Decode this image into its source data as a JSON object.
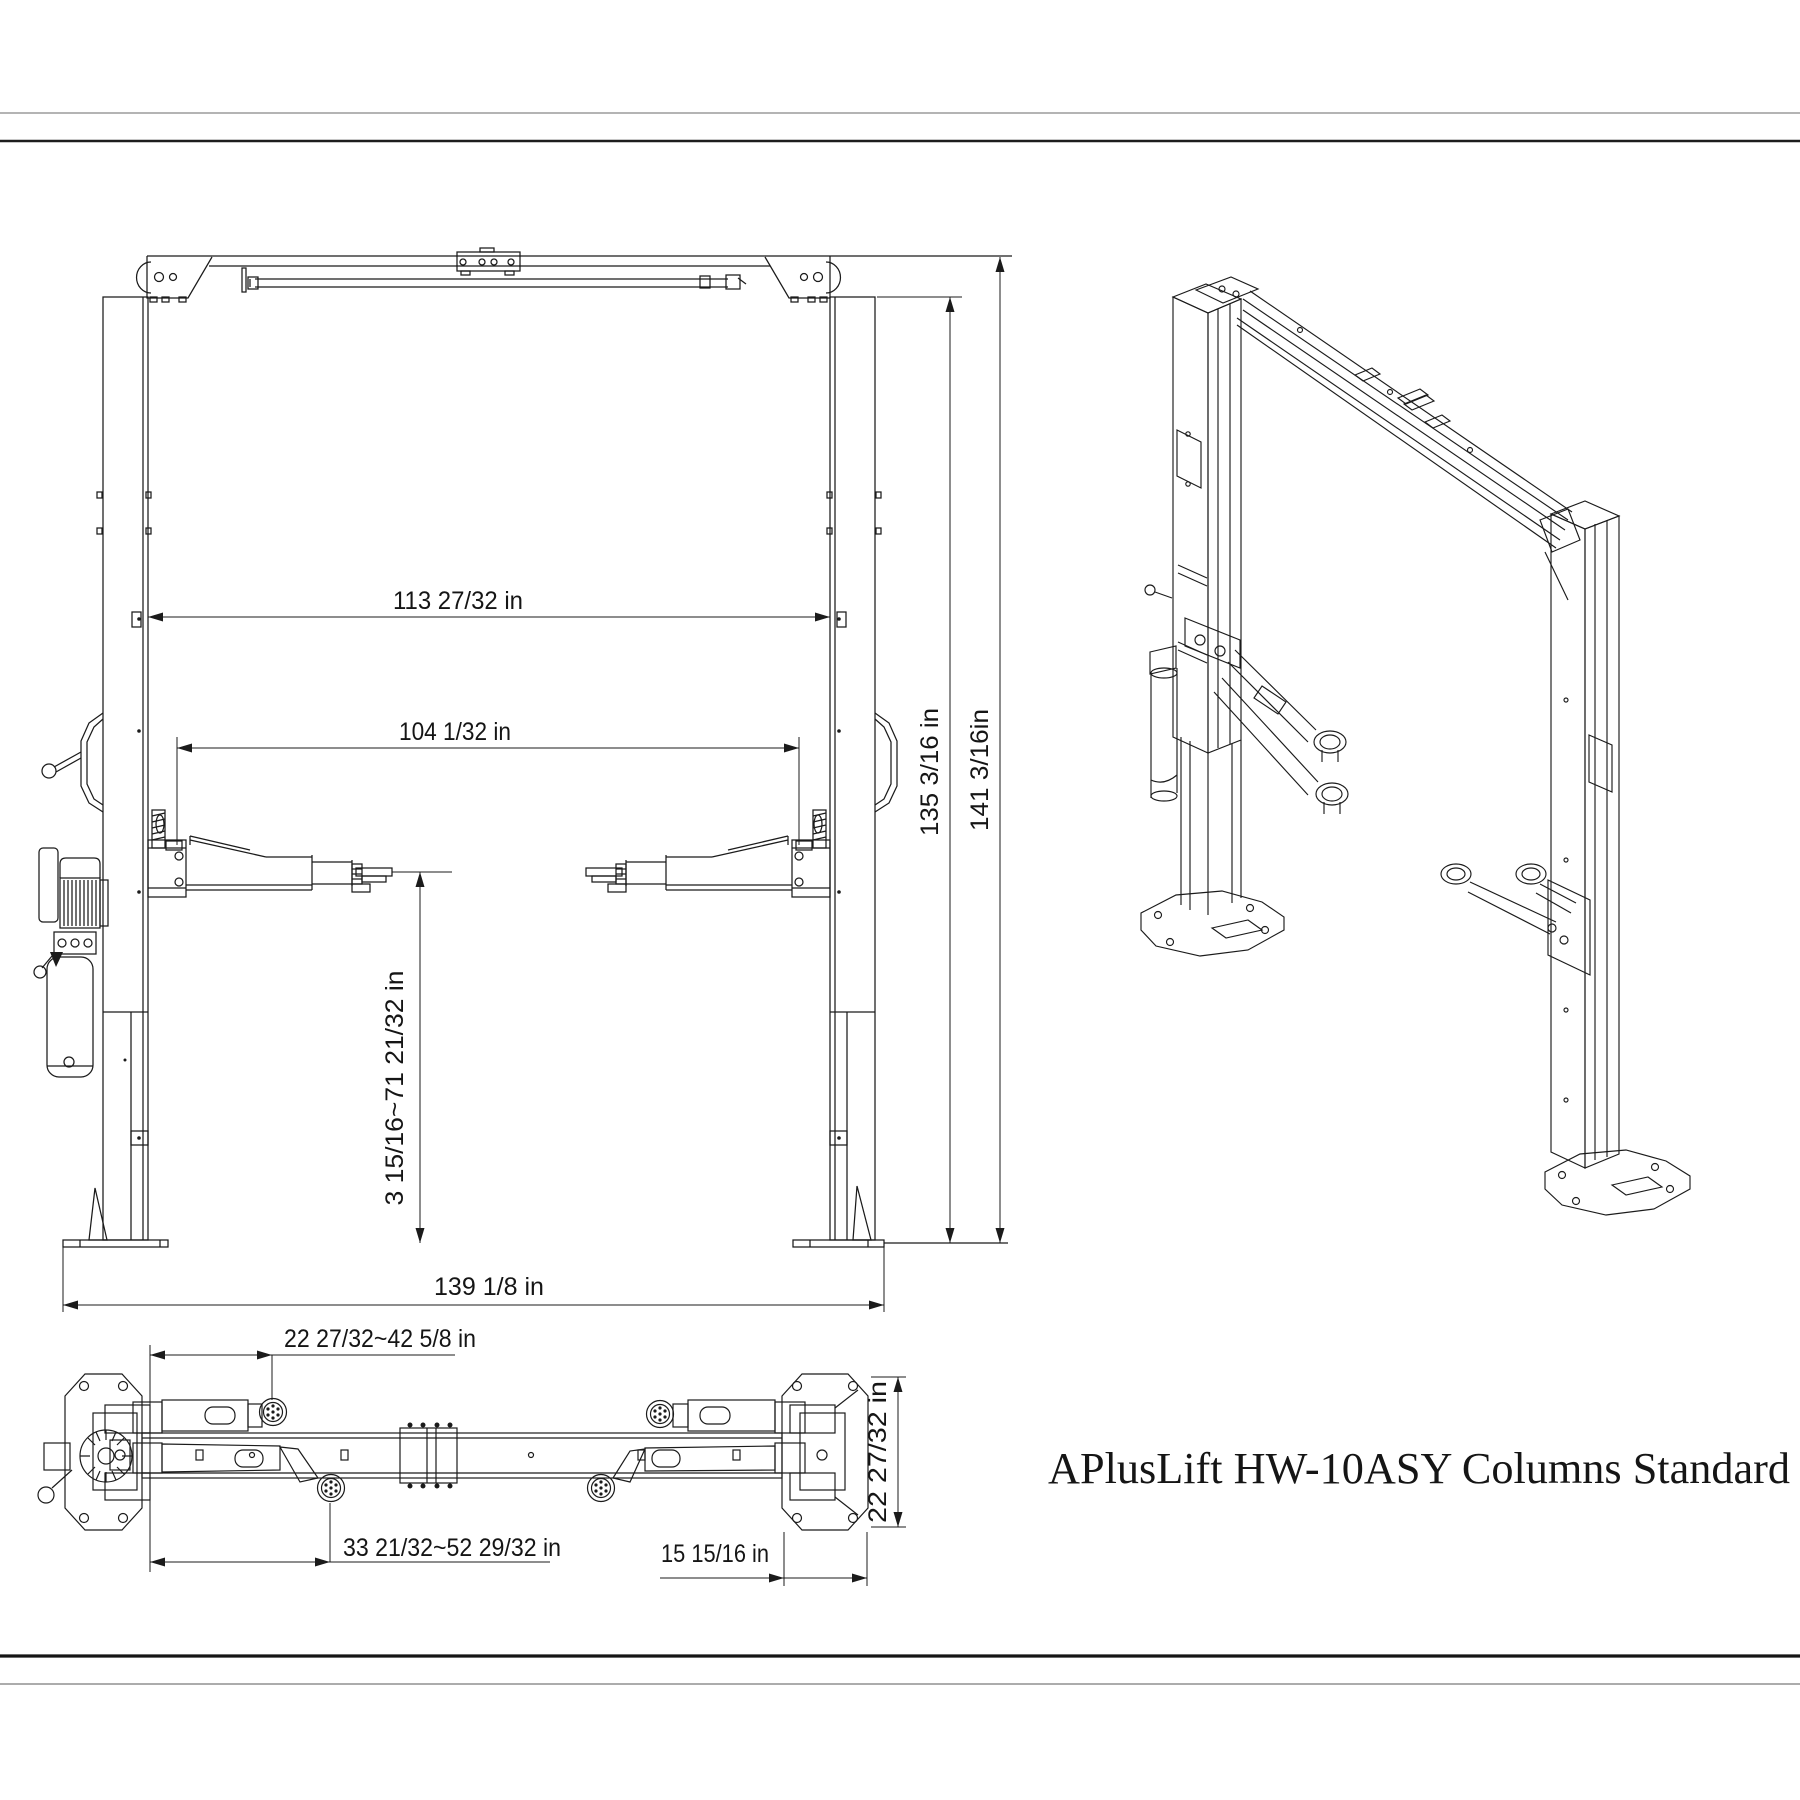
{
  "title": "APlusLift HW-10ASY Columns Standard",
  "front_view": {
    "inside_columns_width": "113 27/32 in",
    "drive_through_width": "104 1/32 in",
    "height_to_column_top": "135 3/16 in",
    "overall_height": "141 3/16in",
    "pad_height_range": "3 15/16~71 21/32 in",
    "overall_base_width": "139 1/8 in"
  },
  "top_view": {
    "front_arm_reach": "22 27/32~42 5/8 in",
    "rear_arm_reach": "33 21/32~52 29/32 in",
    "base_plate_width": "15 15/16 in",
    "base_plate_depth": "22 27/32 in"
  }
}
